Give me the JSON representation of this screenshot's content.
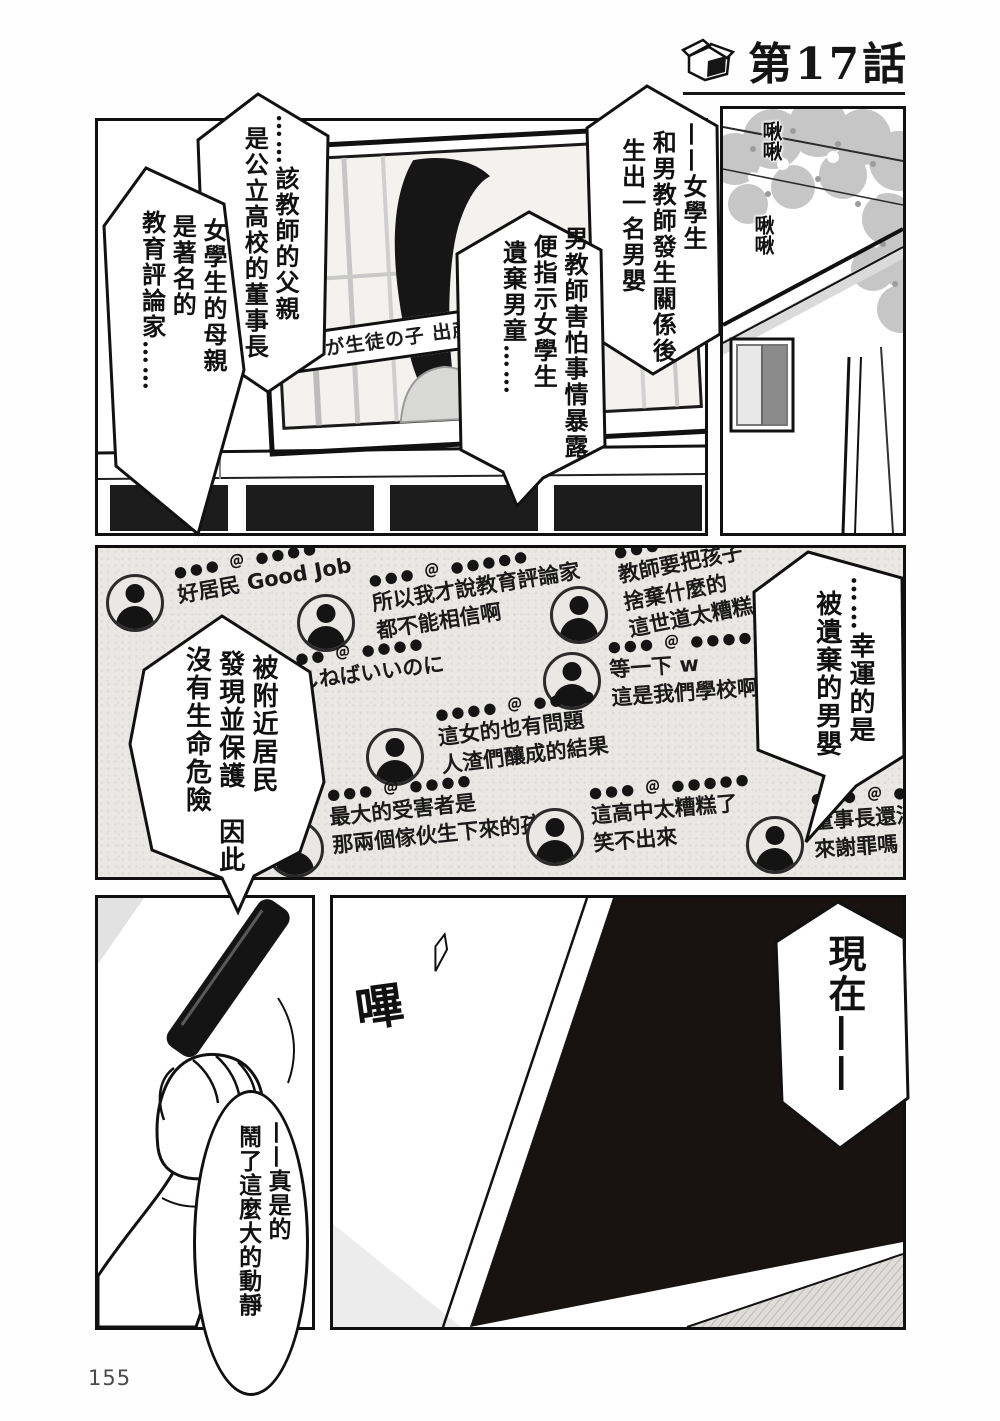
{
  "page_number": "155",
  "header": {
    "chapter_title": "第17話",
    "icon": "open-box-icon"
  },
  "colors": {
    "ink": "#111111",
    "paper": "#ffffff",
    "feed_bg": "#eae8e5",
    "foliage": "#c6c6c6",
    "screen_off": "#181210"
  },
  "panel_tv": {
    "caption": "教師が生徒の子 出産さ"
  },
  "panel_house": {
    "sfx_chirp_1": "啾啾",
    "sfx_chirp_2": "啾啾"
  },
  "panel_tv_off": {
    "sfx_beep": "嗶"
  },
  "bubbles": {
    "b1": {
      "lines": [
        "……該教師的父親",
        "是公立高校的董事長"
      ]
    },
    "b2": {
      "lines": [
        "女學生的母親",
        "是著名的",
        "教育評論家……"
      ]
    },
    "b3": {
      "lines": [
        "——女學生",
        "和男教師發生關係後",
        "生出一名男嬰"
      ]
    },
    "b4": {
      "lines": [
        "男教師害怕事情暴露",
        "便指示女學生",
        "遺棄男童……"
      ]
    },
    "b5": {
      "lines": [
        "被附近居民",
        "發現並保護　因此",
        "沒有生命危險"
      ]
    },
    "b6": {
      "lines": [
        "……幸運的是",
        "被遺棄的男嬰"
      ]
    },
    "b7": {
      "lines": [
        "現在——"
      ]
    },
    "b8": {
      "lines": [
        "——真是的",
        "鬧了這麼大的動靜"
      ]
    }
  },
  "feed": {
    "comments": [
      {
        "handle": "●●● ＠ ●●●●",
        "lines": [
          "好居民 Good Job"
        ]
      },
      {
        "handle": "●●● ＠ ●●●●●",
        "lines": [
          "所以我才說教育評論家",
          "都不能相信啊"
        ]
      },
      {
        "handle": "●●● ＠ ●●●",
        "lines": [
          "教師要把孩子",
          "捨棄什麼的",
          "這世道太糟糕了"
        ]
      },
      {
        "handle": "●●● ＠ ●●●●●",
        "lines": [
          "等一下 w",
          "這是我們學校啊 ww"
        ]
      },
      {
        "handle": "●● ＠ ●●●●",
        "lines": [
          "しねばいいのに"
        ]
      },
      {
        "handle": "●●●● ＠ ●●●●",
        "lines": [
          "這女的也有問題",
          "人渣們釀成的結果"
        ]
      },
      {
        "handle": "●●● ＠ ●●●●",
        "lines": [
          "最大的受害者是",
          "那兩個傢伙生下來的孩子"
        ]
      },
      {
        "handle": "●●● ＠ ●●●●●",
        "lines": [
          "這高中太糟糕了",
          "笑不出來"
        ]
      },
      {
        "handle": "●●● ＠ ●●",
        "lines": [
          "董事長還沒出",
          "來謝罪嗎 ???"
        ]
      }
    ]
  }
}
